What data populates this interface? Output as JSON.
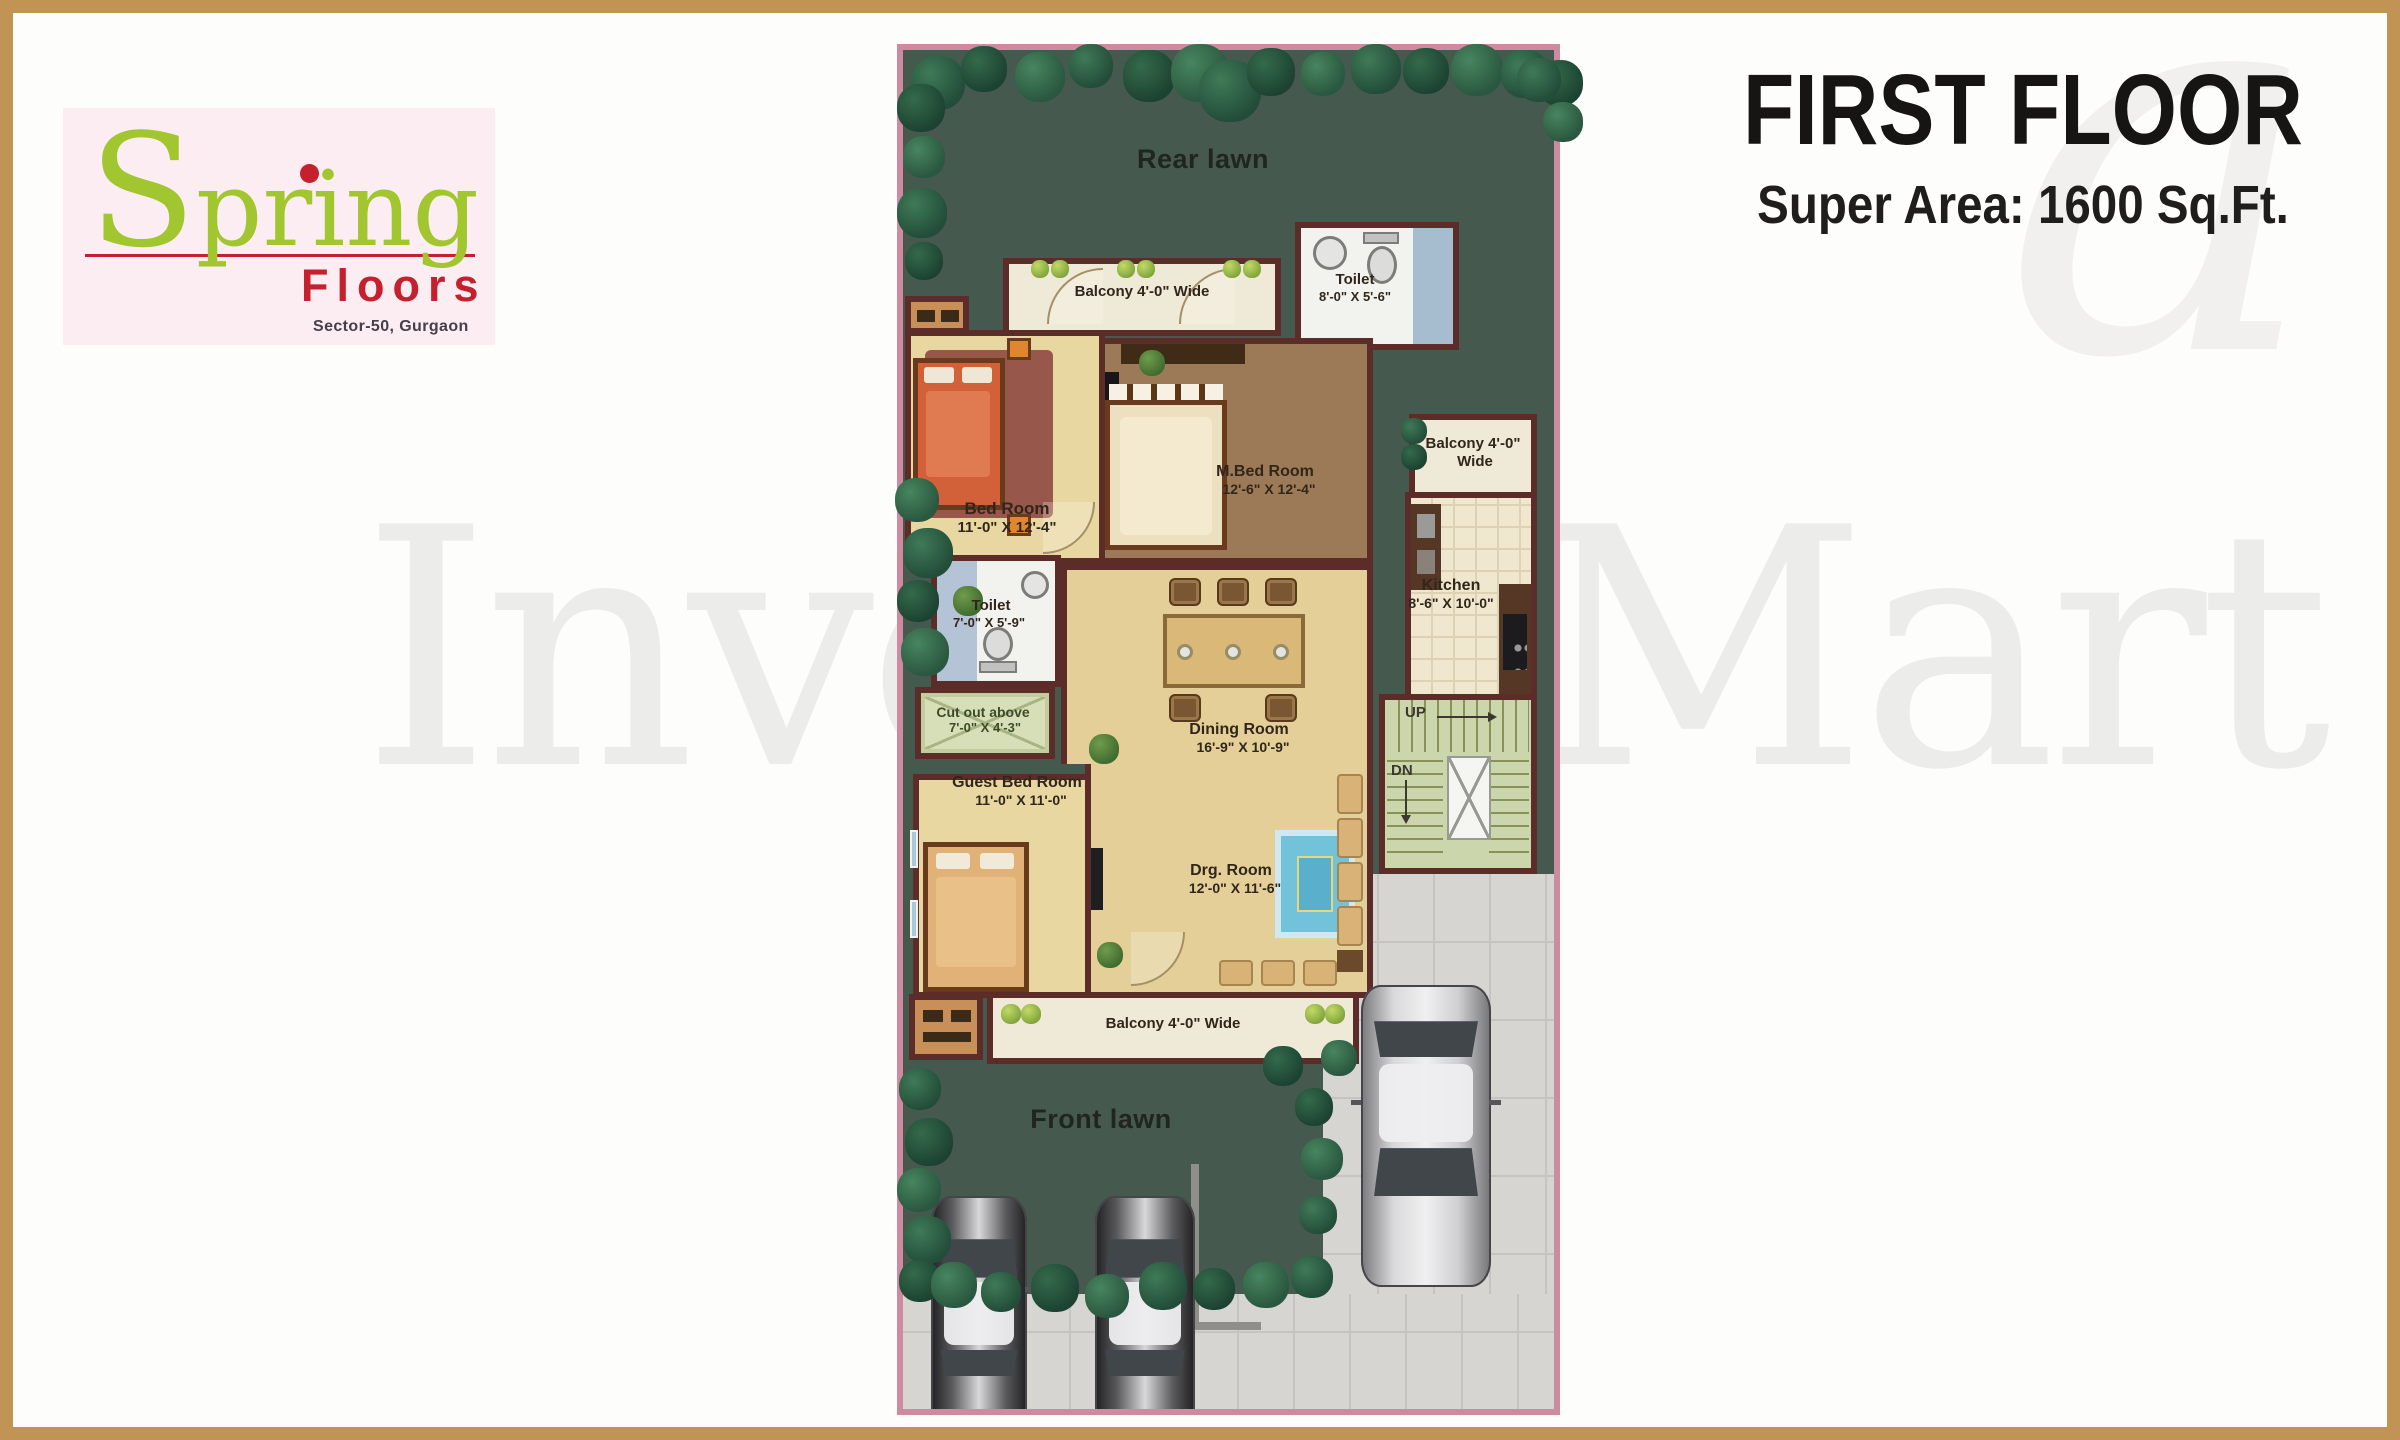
{
  "palette": {
    "frame": "#c19355",
    "page_bg": "#fdfdfb",
    "logo_bg": "#fcedf2",
    "logo_green": "#a2c62f",
    "logo_red": "#c5202e",
    "logo_sub": "#453f4b",
    "ink": "#171513",
    "watermark": "#ececea",
    "plan_border": "#cd8aa0",
    "wall": "#5c2c28",
    "lawn": "#46594e",
    "floor_cream": "#e9d7a2",
    "floor_tan": "#e3cf97",
    "mbed_brown": "#9c7a57",
    "balcony": "#efe9d7",
    "toilet_white": "#f2f2ef",
    "water": "#a6bccf",
    "kitchen_tile": "#f0e7cf",
    "stairs_green": "#ccd6ad",
    "counter": "#553726",
    "driveway": "#d7d5d1",
    "driveway_line": "#c6c4c0",
    "rug_blue": "#72c3da",
    "bed_orange": "#d2613a",
    "sofa_tan": "#d8b276",
    "wood": "#6b4a2c"
  },
  "watermark": {
    "text": "InvestoMart",
    "glyph": "a"
  },
  "logo": {
    "brand": "Spring",
    "sub_brand": "Floors",
    "location": "Sector-50, Gurgaon"
  },
  "header": {
    "title": "FIRST FLOOR",
    "subtitle": "Super Area: 1600 Sq.Ft."
  },
  "plan": {
    "rear_lawn_label": "Rear lawn",
    "front_lawn_label": "Front lawn",
    "balcony_top_label": "Balcony 4'-0\" Wide",
    "balcony_bottom_label": "Balcony 4'-0\" Wide",
    "balcony_right_line1": "Balcony 4'-0\"",
    "balcony_right_line2": "Wide",
    "toilet_top": {
      "name": "Toilet",
      "size": "8'-0\" X 5'-6\""
    },
    "bed_room": {
      "name": "Bed Room",
      "size": "11'-0\" X 12'-4\""
    },
    "m_bed_room": {
      "name": "M.Bed Room",
      "size": "12'-6\" X 12'-4\""
    },
    "kitchen": {
      "name": "Kitchen",
      "size": "8'-6\" X 10'-0\""
    },
    "toilet_mid": {
      "name": "Toilet",
      "size": "7'-0\" X 5'-9\""
    },
    "cut_out": {
      "name": "Cut out above",
      "size": "7'-0\" X 4'-3\""
    },
    "dining_room": {
      "name": "Dining Room",
      "size": "16'-9\" X 10'-9\""
    },
    "guest_bed_room": {
      "name": "Guest Bed Room",
      "size": "11'-0\" X 11'-0\""
    },
    "drg_room": {
      "name": "Drg. Room",
      "size": "12'-0\" X 11'-6\""
    },
    "stairs": {
      "up": "UP",
      "down": "DN"
    }
  }
}
